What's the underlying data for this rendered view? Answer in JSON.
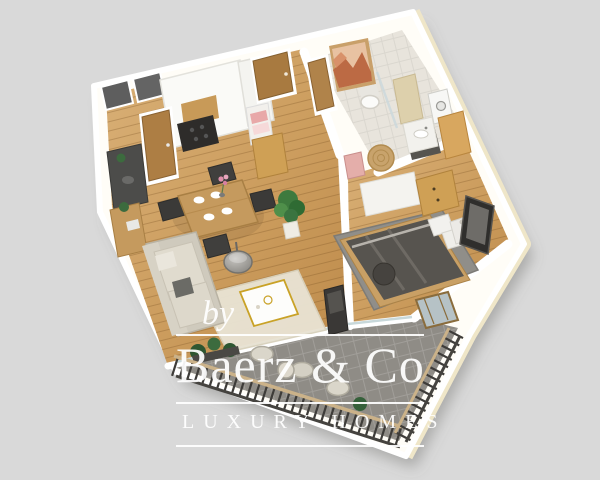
{
  "canvas": {
    "width": 600,
    "height": 480,
    "background_color": "#d9d9d9"
  },
  "watermark": {
    "prefix": "by",
    "brand": "Baerz & Co",
    "tagline": "LUXURY HOMES",
    "text_color": "#ffffff"
  },
  "scene": {
    "type": "3d-floor-plan-render",
    "style": "isometric-apartment-top-view",
    "rooms": [
      {
        "name": "kitchen",
        "features": [
          "white-cabinet-run",
          "dark-cooktop",
          "wood-niche",
          "dark-counter",
          "wooden-door",
          "two-dark-windows"
        ]
      },
      {
        "name": "dining-area",
        "features": [
          "wooden-table",
          "four-dark-chairs",
          "white-place-settings",
          "flower-vase",
          "floor-lamp",
          "potted-plant",
          "sideboard"
        ]
      },
      {
        "name": "living-room",
        "features": [
          "beige-corner-sofa",
          "cream-rug",
          "white-gold-coffee-table",
          "tv-unit"
        ]
      },
      {
        "name": "entry-hall",
        "features": [
          "wooden-entry-door",
          "linen-shelf",
          "low-wooden-cabinet"
        ]
      },
      {
        "name": "bathroom",
        "features": [
          "terracotta-artwork",
          "toilet",
          "shower",
          "vanity-sink",
          "washer",
          "tall-wooden-cabinet",
          "round-jute-rug",
          "laundry-basket"
        ]
      },
      {
        "name": "bedroom",
        "features": [
          "double-bed-dark-bedding",
          "white-pillows",
          "gray-rug",
          "white-wardrobe",
          "wood-drawer-unit",
          "nightstand",
          "dark-framed-picture",
          "glass-bench"
        ]
      },
      {
        "name": "balcony",
        "features": [
          "dark-tile-floor",
          "slatted-railing",
          "outdoor-chairs",
          "planter-boxes"
        ]
      }
    ],
    "palette": {
      "wood_floor_light": "#d6aa6e",
      "wood_floor_dark": "#bd8a4a",
      "wall_top": "#ffffff",
      "wall_outer_face": "#f0e7cb",
      "bathroom_tile": "#e8e4dc",
      "balcony_tile": "#8f8c86",
      "living_rug": "#e9e3d3",
      "bedroom_rug": "#908e89",
      "bedding": "#55524d",
      "railing": "#3e3c39",
      "furniture_wood": "#cfa055",
      "shadow": "rgba(100,100,98,0.4)"
    }
  }
}
